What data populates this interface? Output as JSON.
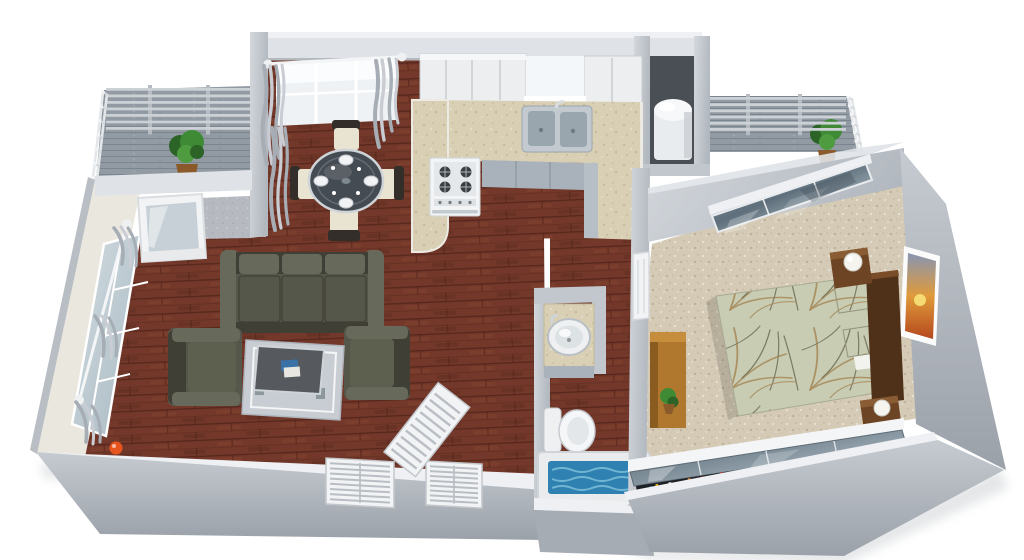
{
  "scene": {
    "description": "3D isometric rendering of a one-bedroom apartment floor plan on a white background",
    "background": "#ffffff"
  },
  "rooms": [
    {
      "id": "balcony-left",
      "label": "Balcony with pergola, railing and potted plant"
    },
    {
      "id": "dining",
      "label": "Dining area with round glass table, four chairs, window with gray curtains"
    },
    {
      "id": "kitchen",
      "label": "U-shaped kitchen with granite counters, double sink, range, white upper cabinets"
    },
    {
      "id": "utility-closet",
      "label": "Utility closet with white water heater"
    },
    {
      "id": "balcony-right",
      "label": "Second balcony with pergola, railing and potted plant"
    },
    {
      "id": "living",
      "label": "Living room with sofa, two armchairs, coffee table on silver rug, hardwood floor, louvered closet doors"
    },
    {
      "id": "bathroom",
      "label": "Bathroom with vanity vessel sink, toilet and filled bathtub"
    },
    {
      "id": "bedroom",
      "label": "Bedroom with double bed, wood headboard, two nightstands with lamps, sunset wall art, console with plant, mirrored closet, sliding glass door"
    }
  ],
  "palette": {
    "background": "#ffffff",
    "wall_top": "#dfe3e8",
    "wall_lip": "#eef0f3",
    "wall_face": "#c2c7cd",
    "wall_face_dark": "#a6acb3",
    "wall_shadow": "#888e95",
    "wall_cream": "#eae7de",
    "closet_dark": "#4a4f55",
    "wood": "#73382a",
    "wood_light": "#8a4731",
    "wood_dark": "#51241a",
    "carpet": "#d4cab5",
    "carpet_dot": "#b4a78e",
    "balcony": "#929ba3",
    "balcony_dark": "#767f88",
    "granite": "#d9cfb5",
    "granite_dot": "#bfb28f",
    "cab_white": "#eceef0",
    "cab_gray": "#a9b2ba",
    "steel": "#c2cad0",
    "steel_dark": "#8d979e",
    "glass_light": "#eef2f5",
    "glass_blue": "#b9c6ce",
    "curtain": "#a7adb5",
    "curtain_light": "#c9cdd3",
    "sofa": "#55574a",
    "sofa_light": "#67695b",
    "sofa_dark": "#403f35",
    "rug": "#c8cdd3",
    "table_top": "#56595d",
    "cream_seat": "#e8e4d1",
    "chair_dark": "#332e29",
    "duvet": "#c8ccb3",
    "duvet_tan": "#ab9264",
    "duvet_gray": "#7b7a62",
    "headboard": "#4f3119",
    "wood_furn": "#6d4524",
    "wood_desk": "#b0782e",
    "lamp": "#f5f4ef",
    "white": "#f7f8f9",
    "water": "#2e81b0",
    "water_light": "#7cc0da",
    "plant": "#3f8a35",
    "plant_dark": "#2c6326",
    "pot": "#8a5a2a",
    "accent_orange": "#e8541d",
    "art_sky": "#8795b3",
    "art_orange": "#e09a3a",
    "art_red": "#b5481e",
    "tile": "#b6bac0",
    "door_white": "#f2f3f5"
  },
  "closet_book_colors": [
    "#b03a2e",
    "#2e86c1",
    "#d4ac0d",
    "#28864f",
    "#e8e8e8",
    "#7d3c98",
    "#1b2631",
    "#ca6f1e",
    "#5d6d7e",
    "#943126",
    "#1a5276",
    "#d0d3d4"
  ],
  "procedural": {
    "closet_books": 40,
    "louver_rows": 8,
    "pergola_rows": 7,
    "railing_posts": 6
  }
}
